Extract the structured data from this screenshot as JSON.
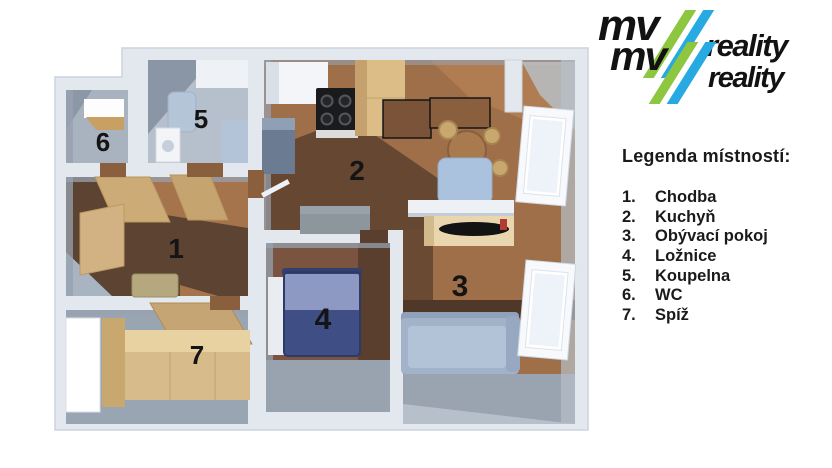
{
  "logo": {
    "word_mv": "mv",
    "word_reality": "reality"
  },
  "legend": {
    "title": "Legenda místností:",
    "items": [
      {
        "num": "1.",
        "label": "Chodba"
      },
      {
        "num": "2.",
        "label": "Kuchyň"
      },
      {
        "num": "3.",
        "label": "Obývací pokoj"
      },
      {
        "num": "4.",
        "label": "Ložnice"
      },
      {
        "num": "5.",
        "label": "Koupelna"
      },
      {
        "num": "6.",
        "label": "WC"
      },
      {
        "num": "7.",
        "label": "Spíž"
      }
    ]
  },
  "plan": {
    "room_numbers": [
      "1",
      "2",
      "3",
      "4",
      "5",
      "6",
      "7"
    ]
  },
  "colors": {
    "brand_green": "#8dc63f",
    "brand_blue": "#27aae1",
    "wall": "#e3e8ee",
    "wall_face": "#97a1af",
    "wood_light": "#d8bb8a",
    "wood_mid": "#9e6f49",
    "wood_dark": "#5e4230",
    "bed_blue": "#3f4f85",
    "couch_blue": "#a2b3c9",
    "text": "#171717"
  }
}
